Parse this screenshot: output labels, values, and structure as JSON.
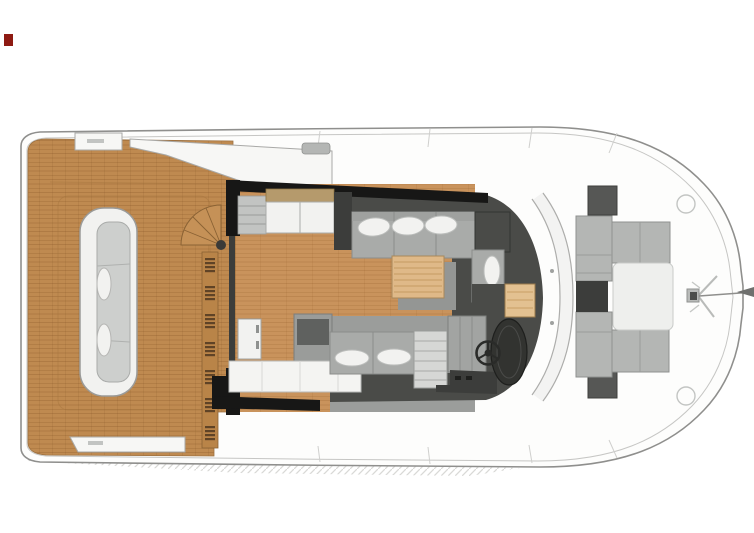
{
  "document": {
    "type": "yacht-main-deck-floor-plan",
    "view": "top-down",
    "orientation": "bow-right",
    "visible_text": ""
  },
  "palette": {
    "teak": "#BF8A50",
    "wood": "#C9935C",
    "charcoal": "#4A4B48",
    "wallblack": "#171716",
    "floorgray": "#9B9D9B",
    "sofagray": "#A9ABA9",
    "loungegray": "#B4B6B4",
    "hatchgray": "#565755",
    "darkwindow": "#3C3D3B",
    "cushion": "#F2F2F0",
    "tablewood": "#DFB988",
    "deckwhite": "#F7F7F5",
    "hullwhite": "#FDFDFC",
    "hullline": "#8F8F8D",
    "marker": "#8E1A12"
  },
  "regions": [
    "aft-teak-deck",
    "cockpit-bench",
    "spiral-staircase",
    "slatted-steps",
    "salon",
    "galley",
    "salon-sofa",
    "coffee-table",
    "chaise",
    "helm-station",
    "steering-wheel",
    "windshield",
    "foredeck-lounge",
    "bow-sunpad",
    "deck-hatches",
    "bow-anchor-fitting",
    "forestay-line"
  ],
  "marker": {
    "color": "#8E1A12",
    "position": "top-left"
  }
}
